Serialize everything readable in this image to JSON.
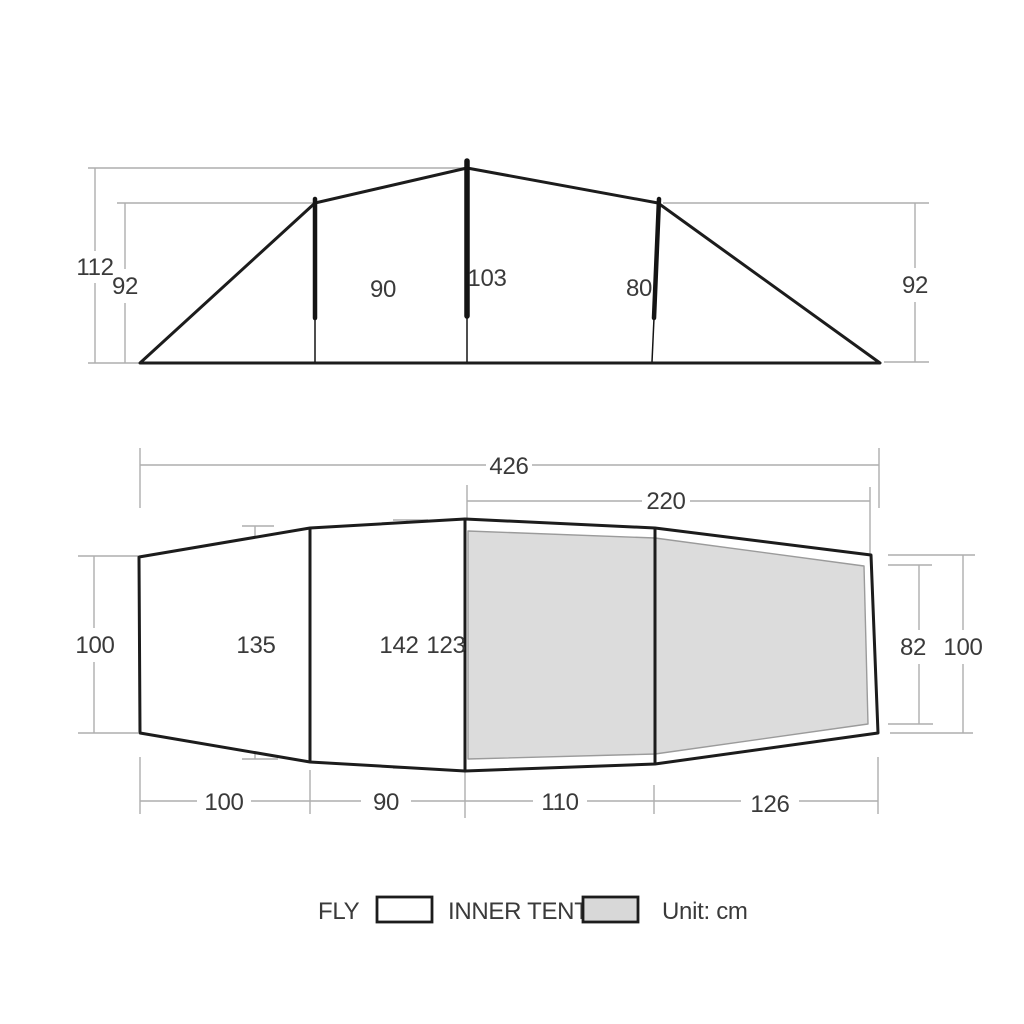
{
  "diagram_unit": "cm",
  "legend": {
    "fly_label": "FLY",
    "inner_tent_label": "INNER TENT",
    "unit_label": "Unit: cm"
  },
  "side_view": {
    "fly_peak_height": "112",
    "front_pole_height": "92",
    "door_height": "90",
    "inner_peak_height": "103",
    "inner_rear_pole_height": "80",
    "rear_pole_height": "92"
  },
  "top_view": {
    "total_length": "426",
    "inner_tent_length": "220",
    "front_end_width": "100",
    "porch_width": "135",
    "mid_fly_width": "142",
    "inner_front_width": "123",
    "inner_rear_width": "82",
    "rear_end_width": "100",
    "front_section_length": "100",
    "porch_section_length": "90",
    "inner_front_section_length": "110",
    "inner_rear_section_length": "126"
  },
  "colors": {
    "background": "#ffffff",
    "tent_outline": "#1c1c1c",
    "inner_tent_fill": "#dcdcdc",
    "inner_tent_stroke": "#9b9b9b",
    "dimension_line": "#aeaeae",
    "label_text": "#3a3a3a"
  }
}
